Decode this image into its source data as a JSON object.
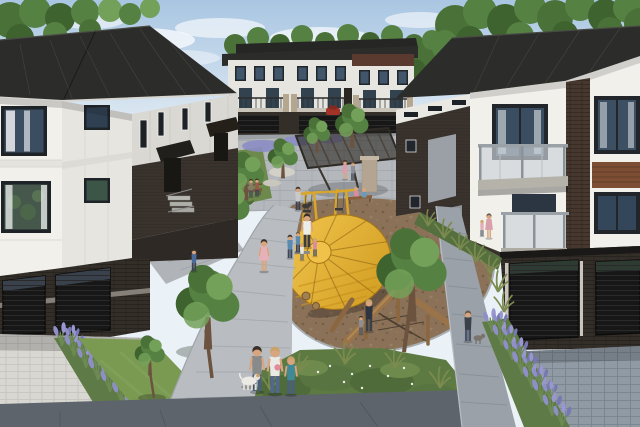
{
  "colors": {
    "sky_top": "#a9c6e2",
    "sky_horizon": "#edf3f8",
    "cloud": "#ffffff",
    "foliage_dark": "#3f632f",
    "foliage": "#558143",
    "foliage_light": "#73a159",
    "roof": "#2c2c2a",
    "fascia": "#d8d6d0",
    "facade_white": "#f1f0eb",
    "facade_shade": "#e6e5df",
    "panel_gray": "#d9d8d2",
    "window_frame": "#21262b",
    "window_glass": "#3b4e61",
    "window_glass_green": "#45584b",
    "curtain": "#eef0f2",
    "siding_dark": "#3a332d",
    "siding_panel": "#9aa0a6",
    "brick_dark": "#342e28",
    "soffit": "#1b1917",
    "garage_door": "#171717",
    "wood_accent": "#7d4e33",
    "stone_pillar": "#b3a591",
    "pergola": "#3e3832",
    "balcony_glass": "#ccd3d9",
    "balcony_rail": "#9aa2a8",
    "balcony_slab": "#b5b2aa",
    "plaza": "#b4b8bc",
    "walkway": "#b9bdc1",
    "sidewalk": "#9aa1a8",
    "sidewalk_dark": "#5d646b",
    "driveway_light": "#d8d7d2",
    "driveway_blue": "#8f9aa4",
    "grass": "#7a9a52",
    "grass_dark": "#637f41",
    "shrub_bed": "#5d7a43",
    "lavender_bed": "#5e7a46",
    "mulch": "#8a7158",
    "mulch_dark": "#6e593f",
    "mulch_light": "#a08a6c",
    "play_yellow": "#e2aa2e",
    "play_yellow_light": "#f0c24a",
    "play_yellow_dark": "#c8931f",
    "play_rib": "#8a5f10",
    "play_knob": "#6fa3c8",
    "log_wood": "#9a7448",
    "lavender": "#8f8fc8",
    "skin": "#d8a57e",
    "denim": "#4a6078",
    "hair_dark": "#3a3028",
    "hair_blonde": "#caa36a",
    "shirt_white": "#e9e9e6",
    "shirt_gray": "#8a8a8a",
    "shirt_teal": "#3f8a96",
    "dress_pink": "#e8b0b8",
    "dog_white": "#eceae4",
    "car_red": "#a33327",
    "maroon_accent": "#5a3a2e"
  }
}
